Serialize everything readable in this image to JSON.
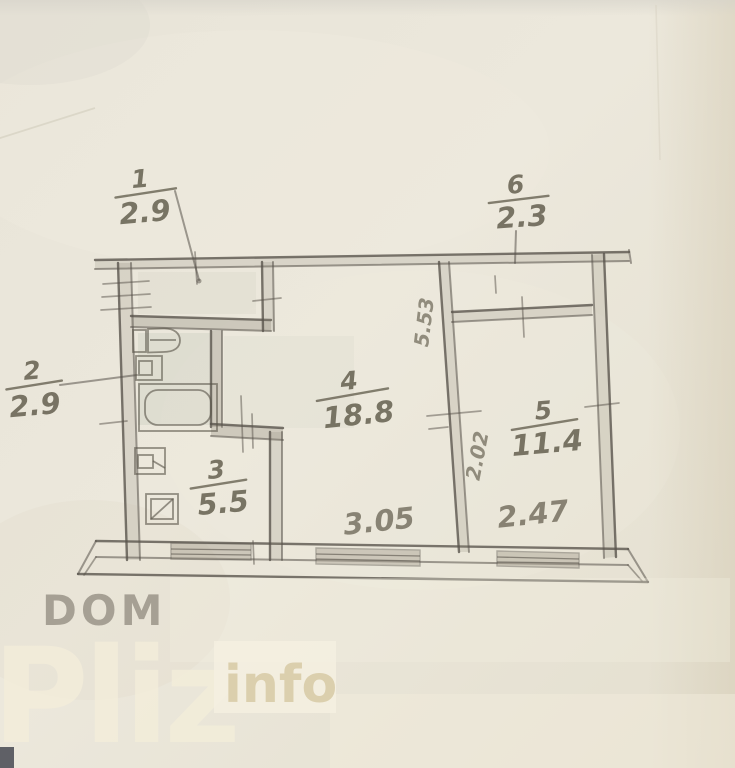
{
  "plan": {
    "rooms": [
      {
        "number": "1",
        "area": "2.9"
      },
      {
        "number": "2",
        "area": "2.9"
      },
      {
        "number": "3",
        "area": "5.5"
      },
      {
        "number": "4",
        "area": "18.8"
      },
      {
        "number": "5",
        "area": "11.4"
      },
      {
        "number": "6",
        "area": "2.3"
      }
    ],
    "dimensions": {
      "room4_width": "3.05",
      "room5_width": "2.47",
      "room4_depth": "5.53",
      "room5_opening": "2.02"
    }
  },
  "watermark": {
    "prefix": "DOM",
    "name": "Pliz",
    "suffix": "info"
  },
  "colors": {
    "pencil": "#57524a",
    "paper": "#e9e5d8",
    "watermark_text": "#f3edda"
  }
}
